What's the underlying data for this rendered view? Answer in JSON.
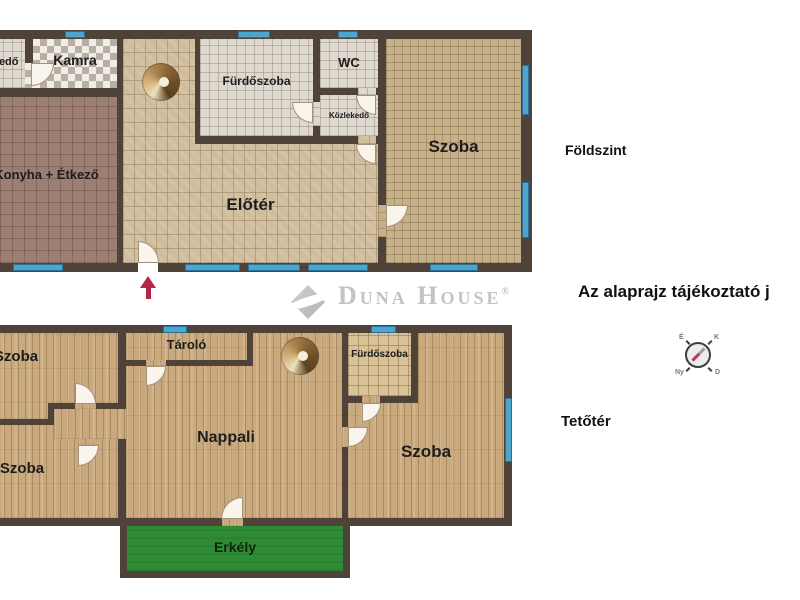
{
  "brand": {
    "name": "Duna House",
    "registered_mark": "®"
  },
  "floor_titles": {
    "ground": "Földszint",
    "attic": "Tetőtér"
  },
  "disclaimer": "Az alaprajz tájékoztató j",
  "ground_floor": {
    "rooms": {
      "kozlekedo_edge": "Közlekedő",
      "kamra": "Kamra",
      "konyha_etkezo": "Konyha + Étkező",
      "eloter": "Előtér",
      "furdoszoba": "Fürdőszoba",
      "wc": "WC",
      "kozlekedo": "Közlekedő",
      "szoba": "Szoba"
    }
  },
  "attic_floor": {
    "rooms": {
      "szoba_top_left": "Szoba",
      "szoba_bottom_left": "Szoba",
      "tarolo": "Tároló",
      "nappali": "Nappali",
      "furdoszoba": "Fürdőszoba",
      "szoba_right": "Szoba",
      "erkely": "Erkély"
    }
  },
  "compass": {
    "north": "É",
    "east": "K",
    "south": "D",
    "west": "Ny"
  },
  "colors": {
    "wall": "#4f4339",
    "window": "#4fa6cd",
    "balcony_green": "#2e8b35",
    "entrance_arrow": "#b3264a",
    "brand_gray": "#c3c3c3"
  }
}
